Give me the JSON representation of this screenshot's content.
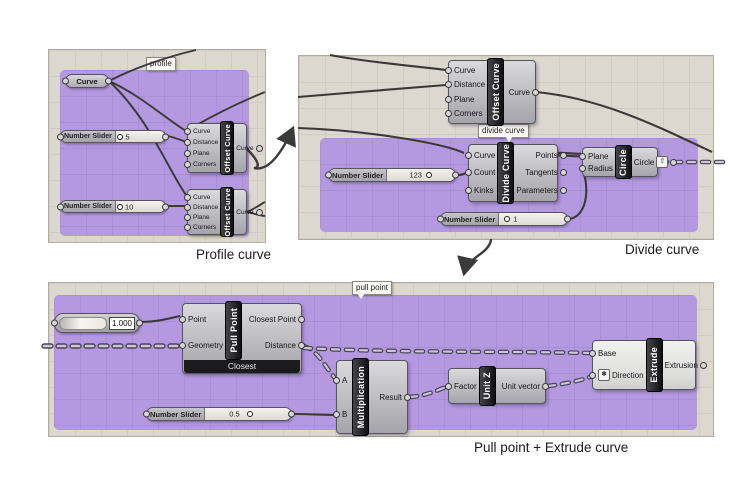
{
  "captions": {
    "profile": "Profile curve",
    "divide": "Divide curve",
    "pull": "Pull point + Extrude curve"
  },
  "tags": {
    "profile": "profile",
    "divide": "divide curve",
    "pull": "pull point"
  },
  "colors": {
    "group_purple": "#b499e1",
    "canvas_bg": "#dcd8cf",
    "wire": "#3c3837",
    "component_dark": "#1b1b1d"
  },
  "profile_panel": {
    "curve_param": "Curve",
    "slider5": {
      "label": "Number Slider",
      "value": "5"
    },
    "slider10": {
      "label": "Number Slider",
      "value": "10"
    },
    "offset1": {
      "title": "Offset Curve",
      "in": [
        "Curve",
        "Distance",
        "Plane",
        "Corners"
      ],
      "out": [
        "Curve"
      ]
    },
    "offset2": {
      "title": "Offset Curve",
      "in": [
        "Curve",
        "Distance",
        "Plane",
        "Corners"
      ],
      "out": [
        "Curve"
      ]
    }
  },
  "divide_panel": {
    "offset": {
      "title": "Offset Curve",
      "in": [
        "Curve",
        "Distance",
        "Plane",
        "Corners"
      ],
      "out": [
        "Curve"
      ]
    },
    "divide": {
      "title": "Divide Curve",
      "in": [
        "Curve",
        "Count",
        "Kinks"
      ],
      "out": [
        "Points",
        "Tangents",
        "Parameters"
      ]
    },
    "slider123": {
      "label": "Number Slider",
      "value": "123"
    },
    "slider1": {
      "label": "Number Slider",
      "value": "1"
    },
    "circle": {
      "title": "Circle",
      "in": [
        "Plane",
        "Radius"
      ],
      "out": [
        "Circle"
      ],
      "out_icon": "up-arrow"
    }
  },
  "pull_panel": {
    "gauge": {
      "value": "1.000"
    },
    "pullpoint": {
      "title": "Pull Point",
      "in": [
        "Point",
        "Geometry"
      ],
      "out": [
        "Closest Point",
        "Distance"
      ],
      "footer": "Closest"
    },
    "mult": {
      "title": "Multiplication",
      "in": [
        "A",
        "B"
      ],
      "out": [
        "Result"
      ]
    },
    "slider05": {
      "label": "Number Slider",
      "value": "0.5"
    },
    "unitz": {
      "title": "Unit Z",
      "in": [
        "Factor"
      ],
      "out": [
        "Unit vector"
      ]
    },
    "extrude": {
      "title": "Extrude",
      "in": [
        "Base",
        "Direction"
      ],
      "out": [
        "Extrusion"
      ],
      "direction_icon": "expression"
    }
  }
}
